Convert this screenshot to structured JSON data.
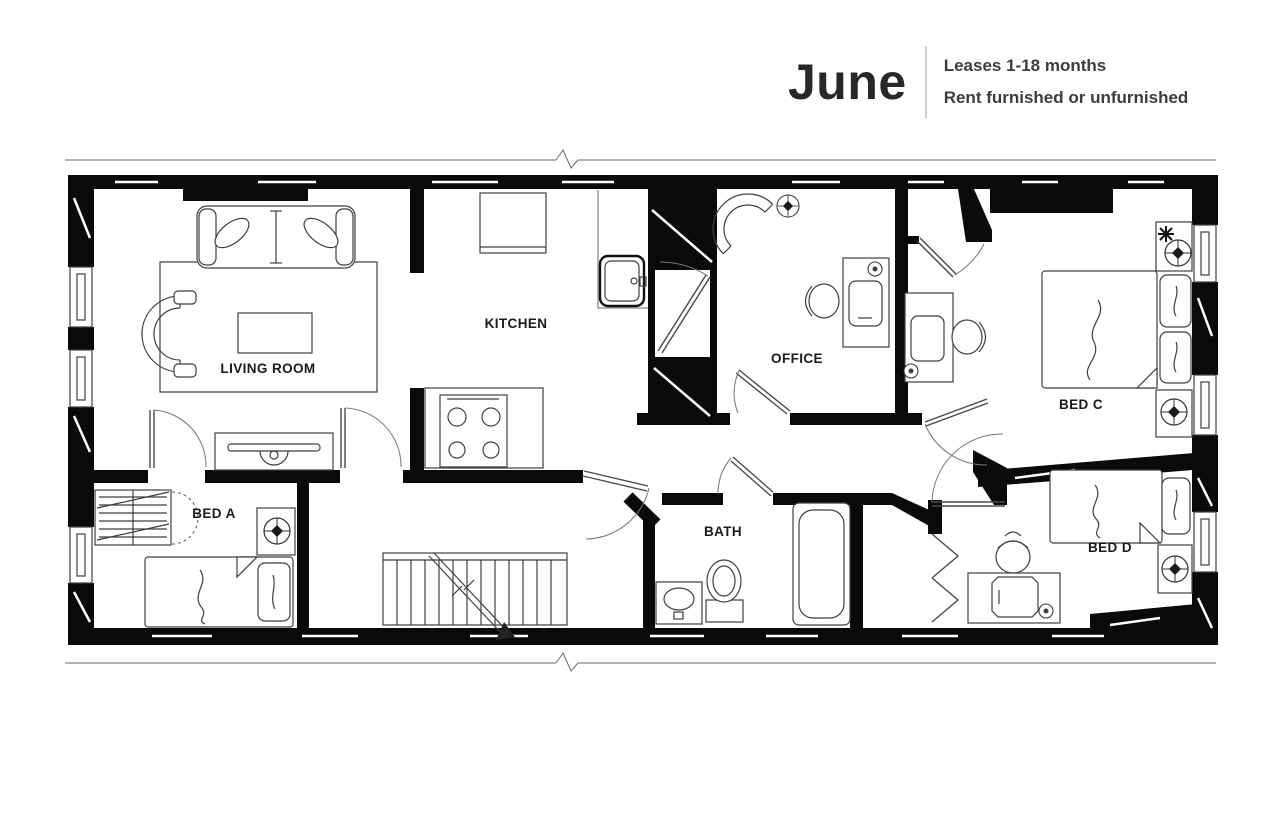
{
  "header": {
    "brand": "June",
    "leases": "Leases 1-18 months",
    "furnish": "Rent furnished or unfurnished"
  },
  "floor_plan": {
    "rooms": {
      "living_room": {
        "label": "LIVING ROOM"
      },
      "kitchen": {
        "label": "KITCHEN"
      },
      "office": {
        "label": "OFFICE"
      },
      "bed_a": {
        "label": "BED A"
      },
      "bed_c": {
        "label": "BED C"
      },
      "bed_d": {
        "label": "BED D"
      },
      "bath": {
        "label": "BATH"
      }
    },
    "colors": {
      "wall": "#0a0a0a",
      "furniture_line": "#3f3f3f",
      "background": "#ffffff",
      "label_text": "#1b1b1b",
      "brand_text": "#26282b"
    }
  }
}
